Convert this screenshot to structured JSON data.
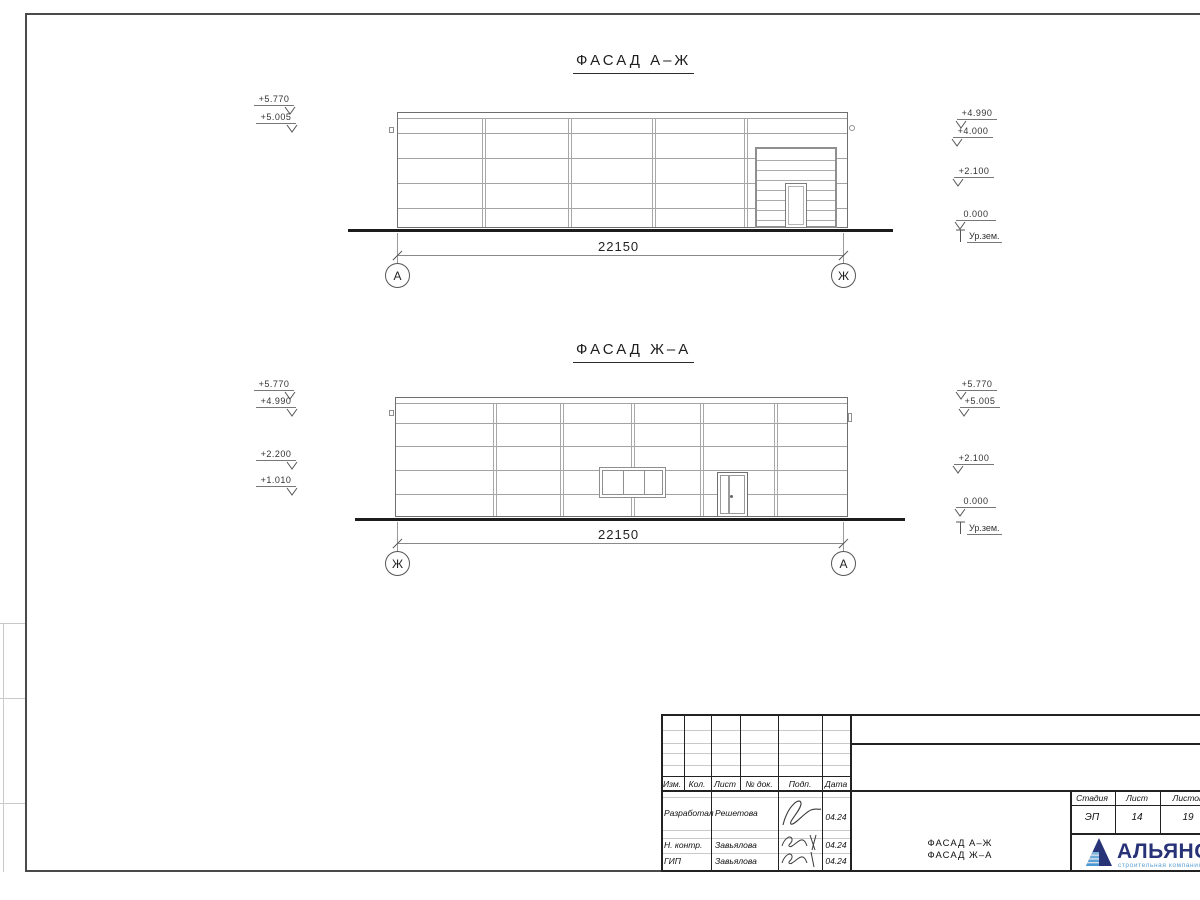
{
  "colors": {
    "line": "#a3a3a3",
    "ground": "#1c1c1c",
    "brand_navy": "#283377",
    "brand_blue": "#7ab4dd"
  },
  "drawing": {
    "facades": [
      {
        "title": "ФАСАД А–Ж",
        "dimension": "22150",
        "axis_left": "А",
        "axis_right": "Ж",
        "marks_left": [
          "+5.770",
          "+5.005"
        ],
        "marks_right": [
          "+4.990",
          "+4.000",
          "+2.100",
          "0.000"
        ],
        "ground_label": "Ур.зем."
      },
      {
        "title": "ФАСАД Ж–А",
        "dimension": "22150",
        "axis_left": "Ж",
        "axis_right": "А",
        "marks_left": [
          "+5.770",
          "+4.990",
          "+2.200",
          "+1.010"
        ],
        "marks_right": [
          "+5.770",
          "+5.005",
          "+2.100",
          "0.000"
        ],
        "ground_label": "Ур.зем."
      }
    ]
  },
  "title_block": {
    "headers": [
      "Изм.",
      "Кол.",
      "Лист",
      "№ док.",
      "Подп.",
      "Дата"
    ],
    "rows": [
      {
        "role": "Разработал",
        "name": "Решетова",
        "date": "04.24"
      },
      {
        "role": "Н. контр.",
        "name": "Завьялова",
        "date": "04.24"
      },
      {
        "role": "ГИП",
        "name": "Завьялова",
        "date": "04.24"
      }
    ],
    "stage_label": "Стадия",
    "sheet_label": "Лист",
    "sheets_label": "Листов",
    "stage": "ЭП",
    "sheet": "14",
    "sheets": "19",
    "doc_title_line1": "ФАСАД А–Ж",
    "doc_title_line2": "ФАСАД Ж–А",
    "logo": {
      "name": "АЛЬЯНС",
      "subtitle": "строительная компания"
    }
  }
}
